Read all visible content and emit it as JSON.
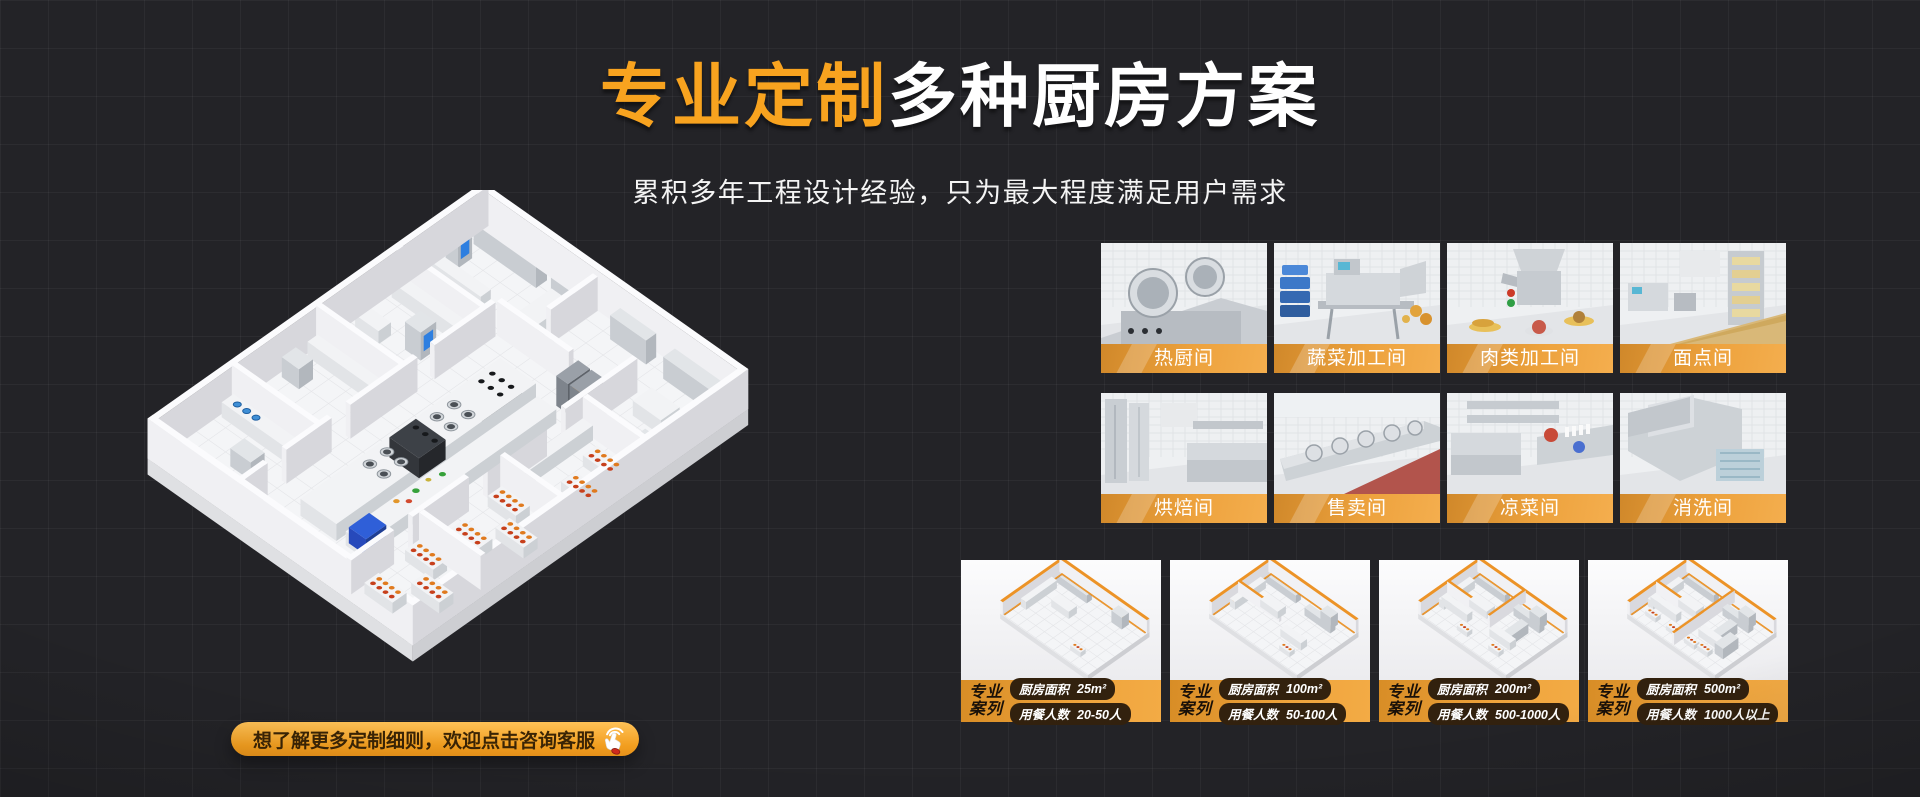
{
  "hero": {
    "title_highlight": "专业定制",
    "title_rest": "多种厨房方案",
    "subtitle": "累积多年工程设计经验，只为最大程度满足用户需求"
  },
  "rooms": [
    {
      "label": "热厨间"
    },
    {
      "label": "蔬菜加工间"
    },
    {
      "label": "肉类加工间"
    },
    {
      "label": "面点间"
    },
    {
      "label": "烘焙间"
    },
    {
      "label": "售卖间"
    },
    {
      "label": "凉菜间"
    },
    {
      "label": "消洗间"
    }
  ],
  "cases": [
    {
      "badge": [
        "专业",
        "案列"
      ],
      "rows": [
        {
          "label": "厨房面积",
          "value": "25m²"
        },
        {
          "label": "用餐人数",
          "value": "20-50人"
        }
      ]
    },
    {
      "badge": [
        "专业",
        "案列"
      ],
      "rows": [
        {
          "label": "厨房面积",
          "value": "100m²"
        },
        {
          "label": "用餐人数",
          "value": "50-100人"
        }
      ]
    },
    {
      "badge": [
        "专业",
        "案列"
      ],
      "rows": [
        {
          "label": "厨房面积",
          "value": "200m²"
        },
        {
          "label": "用餐人数",
          "value": "500-1000人"
        }
      ]
    },
    {
      "badge": [
        "专业",
        "案列"
      ],
      "rows": [
        {
          "label": "厨房面积",
          "value": "500m²"
        },
        {
          "label": "用餐人数",
          "value": "1000人以上"
        }
      ]
    }
  ],
  "cta": {
    "label": "想了解更多定制细则，欢迎点击咨询客服"
  },
  "icons": {
    "cta": "click-hand-icon"
  },
  "colors": {
    "background": "#232327",
    "accent_orange": "#F8A31F",
    "band_orange": "#EDA23D",
    "pill_bg": "#32210E",
    "cta_text": "#3A2405"
  }
}
